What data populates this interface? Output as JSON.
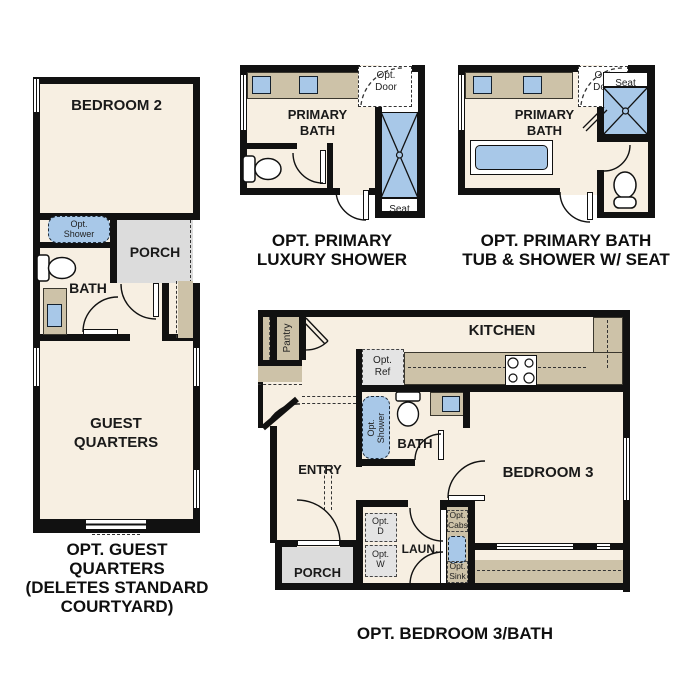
{
  "document_title": "Optional floor plan configurations sheet",
  "colors": {
    "wall": "#111111",
    "floor": "#f7efe2",
    "counter": "#cdc2a8",
    "porch": "#dcdcdc",
    "opt_area": "#e4e4e4",
    "fixture_blue": "#a8c8e8",
    "text": "#1a1a1a",
    "background": "#ffffff"
  },
  "plans": {
    "guest_quarters": {
      "labels": {
        "bedroom2": "BEDROOM 2",
        "opt_shower_l1": "Opt.",
        "opt_shower_l2": "Shower",
        "porch": "PORCH",
        "bath": "BATH",
        "guest_l1": "GUEST",
        "guest_l2": "QUARTERS"
      },
      "caption": [
        "OPT. GUEST QUARTERS",
        "(DELETES STANDARD",
        "COURTYARD)"
      ]
    },
    "luxury_shower": {
      "labels": {
        "primary_l1": "PRIMARY",
        "primary_l2": "BATH",
        "opt_door_l1": "Opt.",
        "opt_door_l2": "Door",
        "seat": "Seat"
      },
      "caption": [
        "OPT. PRIMARY",
        "LUXURY SHOWER"
      ]
    },
    "tub_shower": {
      "labels": {
        "primary_l1": "PRIMARY",
        "primary_l2": "BATH",
        "opt_door_l1": "Opt.",
        "opt_door_l2": "Door",
        "seat": "Seat"
      },
      "caption": [
        "OPT. PRIMARY BATH",
        "TUB & SHOWER W/ SEAT"
      ]
    },
    "bedroom3_bath": {
      "labels": {
        "kitchen": "KITCHEN",
        "pantry": "Pantry",
        "opt_ref_l1": "Opt.",
        "opt_ref_l2": "Ref",
        "opt_shower_l1": "Opt.",
        "opt_shower_l2": "Shower",
        "bath": "BATH",
        "entry": "ENTRY",
        "porch": "PORCH",
        "opt_d_l1": "Opt.",
        "opt_d_l2": "D",
        "opt_w_l1": "Opt.",
        "opt_w_l2": "W",
        "laun": "LAUN.",
        "opt_cabs_l1": "Opt.",
        "opt_cabs_l2": "Cabs",
        "opt_sink_l1": "Opt.",
        "opt_sink_l2": "Sink",
        "bedroom3": "BEDROOM 3"
      },
      "caption": [
        "OPT. BEDROOM 3/BATH"
      ]
    }
  }
}
